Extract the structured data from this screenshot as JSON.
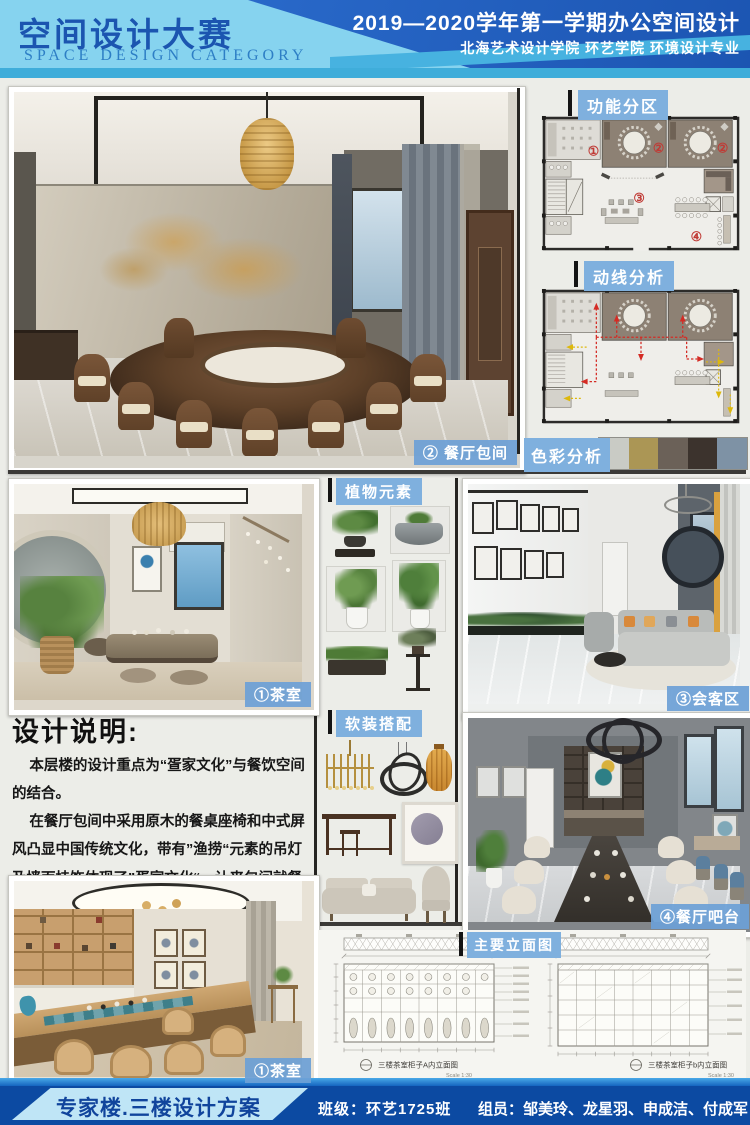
{
  "header": {
    "title_cn": "空间设计大赛",
    "title_en": "SPACE DESIGN CATEGORY",
    "term_line": "2019—2020学年第一学期办公空间设计",
    "school_line": "北海艺术设计学院  环艺学院  环境设计专业"
  },
  "section_labels": {
    "functional_zoning": "功能分区",
    "circulation": "动线分析",
    "color_analysis": "色彩分析",
    "plants": "植物元素",
    "soft_furnishing": "软装搭配",
    "elevations": "主要立面图"
  },
  "color_swatches": [
    "#c9cbc5",
    "#ab9655",
    "#6b6158",
    "#3c332d",
    "#7e92a5"
  ],
  "floor_plan": {
    "zone1": "①",
    "zone2": "②",
    "zone3": "③",
    "zone4": "④"
  },
  "photo_labels": {
    "dining_room": "② 餐厅包间",
    "tea_room": "①茶室",
    "reception": "③会客区",
    "dining_bar": "④餐厅吧台",
    "tea_room_2": "①茶室"
  },
  "design_notes": {
    "title": "设计说明:",
    "paragraph1": "本层楼的设计重点为“疍家文化”与餐饮空间的结合。",
    "paragraph2": "在餐厅包间中采用原木的餐桌座椅和中式屏风凸显中国传统文化，带有”渔捞“元素的吊灯及墙面挂饰体现了”疍家文化“，让来包间就餐的客户在感受中国饮食的魅力同时又能了解到北海传统疍家文化。另外在本层楼我们还设置了茶室、会客区、休闲吧台区，用于满足接待客人和就餐的需求。"
  },
  "elevations": {
    "captions": [
      {
        "title": "三楼茶室柜子A内立面图",
        "scale": "Scale 1:30"
      },
      {
        "title": "三楼茶室柜子b内立面图",
        "scale": "Scale 1:30"
      }
    ]
  },
  "footer": {
    "project": "专家楼.三楼设计方案",
    "class_line": "班级：环艺1725班",
    "members_line": "组员：邹美玲、龙星羽、申成洁、付成军"
  },
  "plants_items": [
    "bonsai",
    "stone-water-bowl",
    "bamboo-plant",
    "bird-of-paradise",
    "planter-box",
    "flower-stand"
  ],
  "soft_items": [
    "brass-chandelier",
    "ring-pendant",
    "rattan-lantern",
    "console-table",
    "round-artwork",
    "sofa",
    "lounge-chair"
  ]
}
